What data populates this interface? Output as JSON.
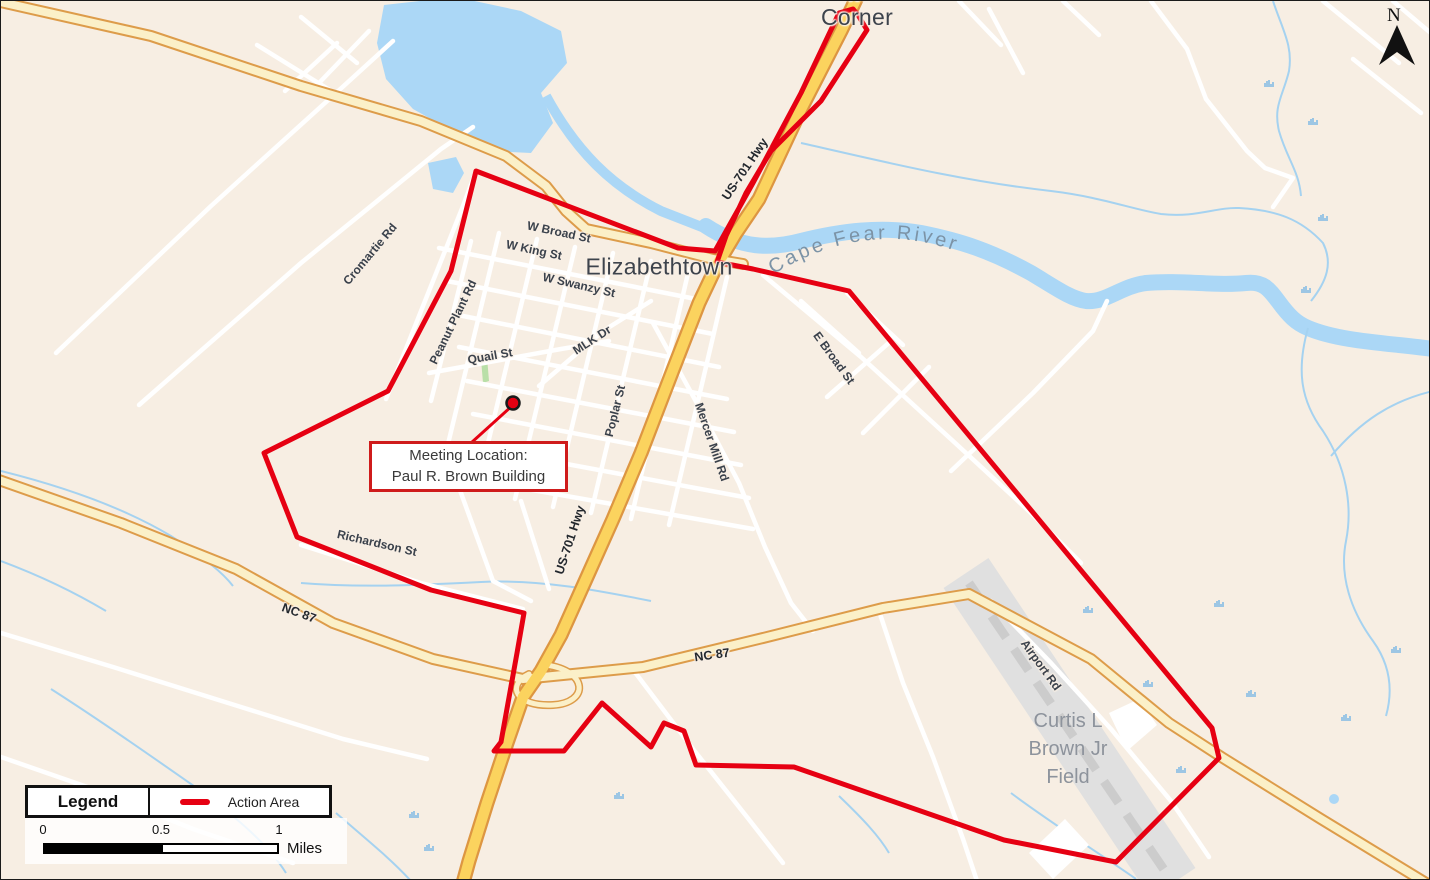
{
  "map": {
    "place_labels": {
      "suttons_corner": "Suttons Corner",
      "elizabethtown": "Elizabethtown",
      "cape_fear_river": "Cape Fear River",
      "curtis_field": "Curtis L Brown Jr Field"
    },
    "street_labels": [
      {
        "text": "W Broad St"
      },
      {
        "text": "W King St"
      },
      {
        "text": "W Swanzy St"
      },
      {
        "text": "MLK Dr"
      },
      {
        "text": "Quail St"
      },
      {
        "text": "Cromartie Rd"
      },
      {
        "text": "Peanut Plant Rd"
      },
      {
        "text": "Richardson St"
      },
      {
        "text": "Poplar St"
      },
      {
        "text": "US-701 Hwy"
      },
      {
        "text": "US-701 Hwy"
      },
      {
        "text": "Mercer Mill Rd"
      },
      {
        "text": "E Broad St"
      },
      {
        "text": "Airport Rd"
      },
      {
        "text": "NC 87"
      },
      {
        "text": "NC 87"
      }
    ]
  },
  "callout": {
    "line1": "Meeting Location:",
    "line2": "Paul R. Brown Building"
  },
  "legend": {
    "title": "Legend",
    "items": [
      {
        "label": "Action Area",
        "color": "#e60012"
      }
    ]
  },
  "scale_bar": {
    "ticks": [
      "0",
      "0.5",
      "1"
    ],
    "unit": "Miles"
  },
  "north": {
    "label": "N"
  },
  "colors": {
    "action_area": "#e60012",
    "water": "#abd7f6",
    "highway_gold": "#fbd35e",
    "highway_pale": "#fbf0c8",
    "background": "#f7eee3",
    "runway_gray": "#dedede"
  }
}
